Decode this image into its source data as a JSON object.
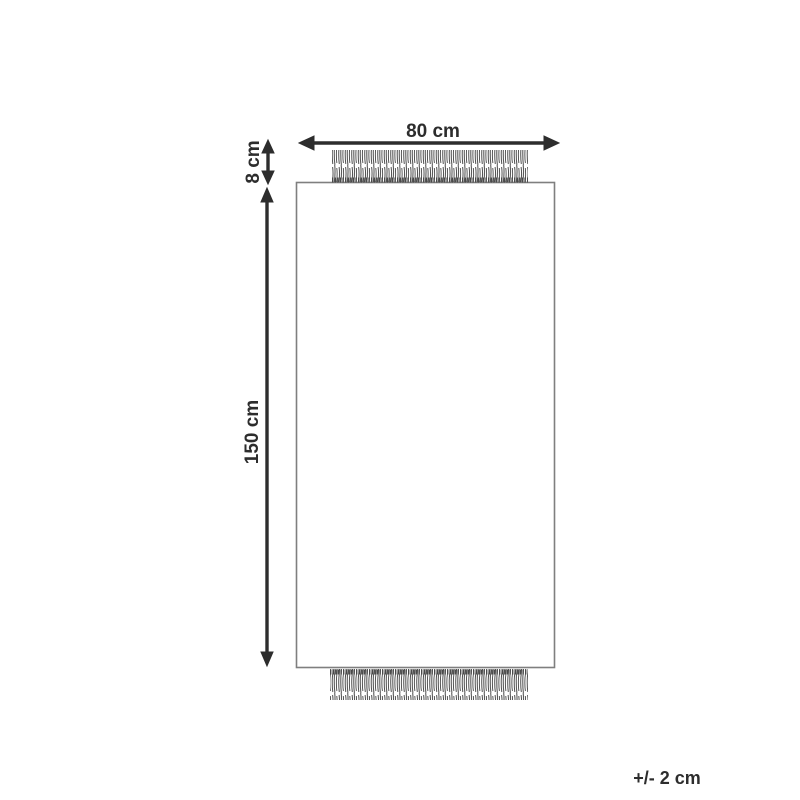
{
  "diagram": {
    "labels": {
      "width": "80 cm",
      "fringe_height": "8 cm",
      "length": "150 cm",
      "tolerance": "+/- 2 cm"
    },
    "colors": {
      "background": "#ffffff",
      "arrow": "#2d2d2d",
      "outline": "#7f7f7f",
      "fringe": "#4f4f4f"
    }
  }
}
